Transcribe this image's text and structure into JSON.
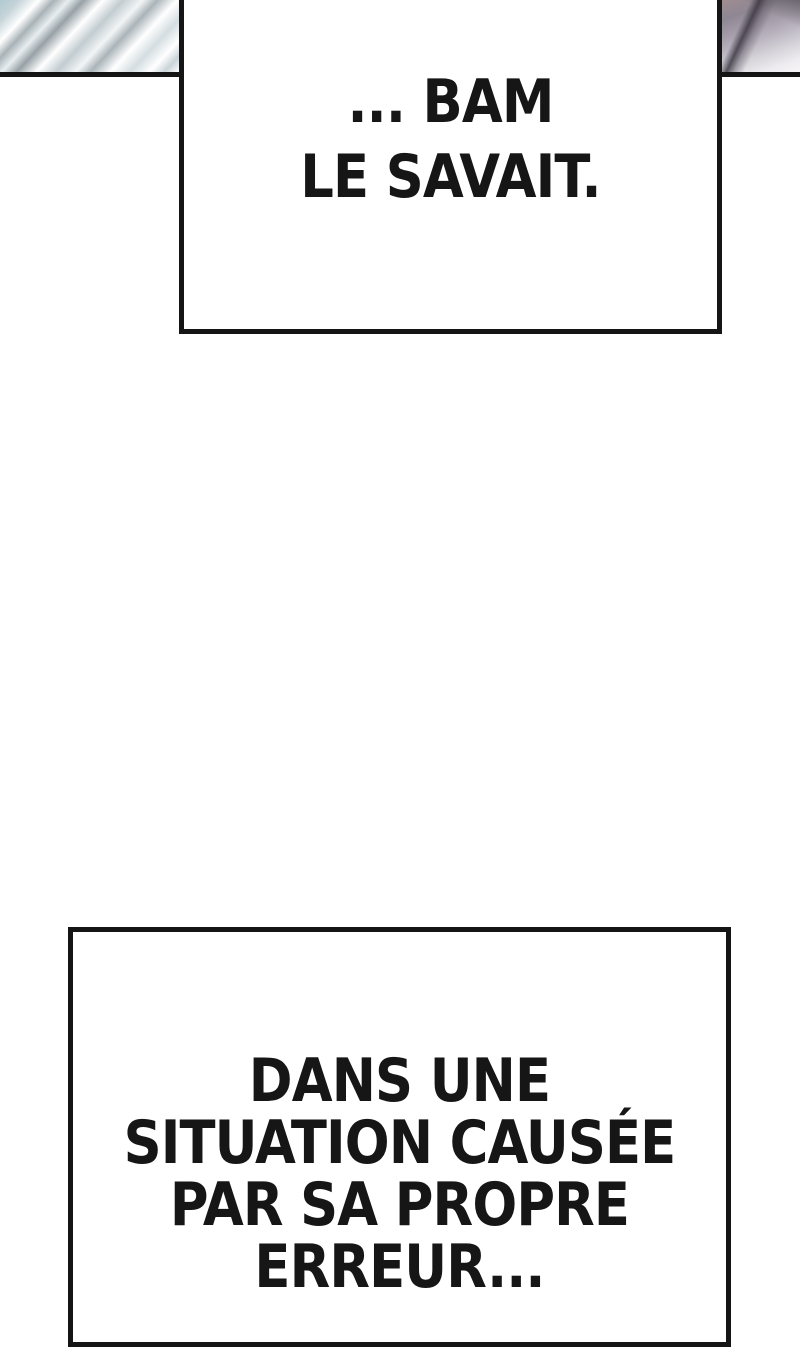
{
  "page": {
    "colors": {
      "paper": "#ffffff",
      "ink": "#151515",
      "art_left_palette": [
        "#aec9cf",
        "#97a1a6",
        "#e8eef0",
        "#ffffff",
        "#c2ccd1"
      ],
      "art_right_palette": [
        "#a08d92",
        "#8e8793",
        "#b9b3bf",
        "#3c3742",
        "#edebef"
      ]
    }
  },
  "captions": {
    "top": {
      "lines": [
        "... BAM",
        "LE SAVAIT."
      ]
    },
    "bottom": {
      "lines": [
        "DANS UNE",
        "SITUATION CAUSÉE",
        "PAR SA PROPRE",
        "ERREUR..."
      ]
    }
  }
}
